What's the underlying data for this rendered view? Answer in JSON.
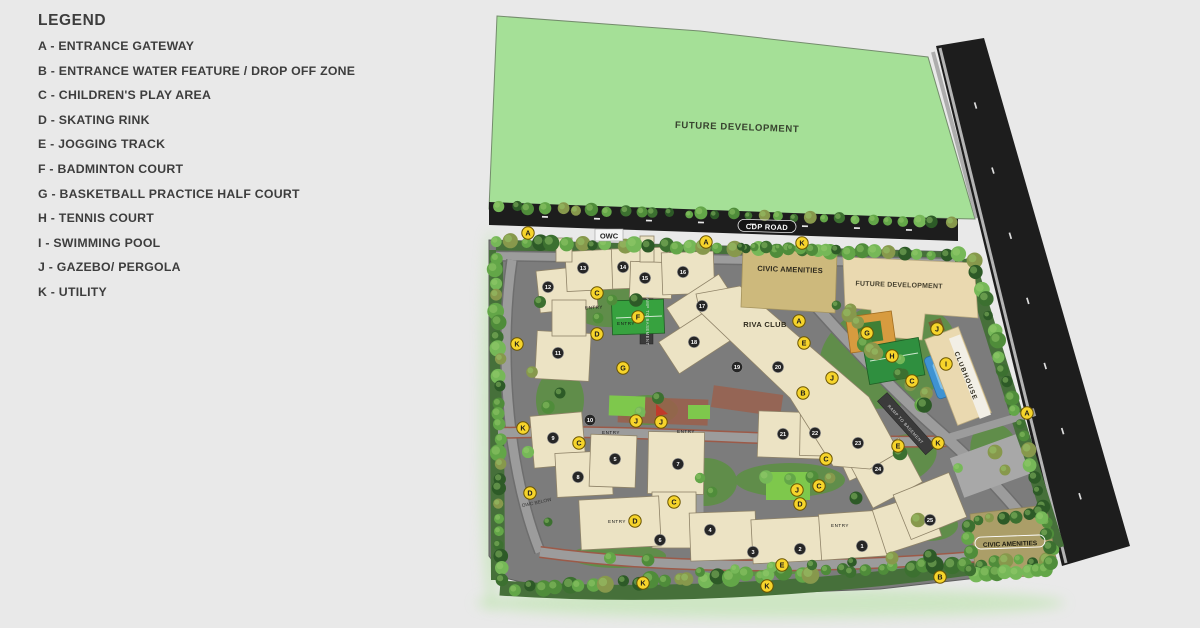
{
  "theme": {
    "page-bg": "#e9e9e9",
    "text-dark": "#3d3d3d",
    "green-area": "#a5e097",
    "road-black": "#1d1d1d",
    "site-gray": "#7c7c7c",
    "road-gray": "#9c9c9c",
    "building": "#ece3c4",
    "building-edge": "#8f8368",
    "civic-tan": "#cdb97c",
    "civic-olive": "#ab9e68",
    "beige": "#ead9b0",
    "court-orange": "#d79b3f",
    "court-green": "#2f8f3f",
    "pool-blue": "#3f93d2",
    "lawn": "#7ec84c",
    "plaza-rust": "#9b5f4b",
    "marker-yellow": "#f6d42b",
    "tower-dark": "#262626"
  },
  "legend": {
    "title": "LEGEND",
    "items": [
      {
        "key": "A",
        "text": "A - ENTRANCE GATEWAY"
      },
      {
        "key": "B",
        "text": "B - ENTRANCE WATER FEATURE / DROP OFF ZONE"
      },
      {
        "key": "C",
        "text": "C - CHILDREN'S PLAY AREA"
      },
      {
        "key": "D",
        "text": "D - SKATING RINK"
      },
      {
        "key": "E",
        "text": "E - JOGGING TRACK"
      },
      {
        "key": "F",
        "text": "F - BADMINTON COURT"
      },
      {
        "key": "G",
        "text": "G - BASKETBALL PRACTICE HALF COURT"
      },
      {
        "key": "H",
        "text": "H - TENNIS COURT"
      },
      {
        "key": "I",
        "text": "I - SWIMMING POOL"
      },
      {
        "key": "J",
        "text": "J - GAZEBO/ PERGOLA"
      },
      {
        "key": "K",
        "text": "K - UTILITY"
      }
    ]
  },
  "map": {
    "labels": {
      "future_development_top": "FUTURE DEVELOPMENT",
      "cdp_road": "CDP ROAD",
      "owc": "OWC",
      "civic_amenities_top": "CIVIC AMENITIES",
      "future_development_right": "FUTURE DEVELOPMENT",
      "riva_club": "RIVA CLUB",
      "clubhouse": "CLUBHOUSE",
      "civic_amenities_bottom": "CIVIC AMENITIES",
      "owc_below": "OWC BELOW",
      "ramp_to_basement": "RAMP TO BASEMENT",
      "entry": "ENTRY"
    },
    "markers": [
      {
        "letter": "A",
        "x": 528,
        "y": 233
      },
      {
        "letter": "A",
        "x": 706,
        "y": 242
      },
      {
        "letter": "A",
        "x": 799,
        "y": 321
      },
      {
        "letter": "A",
        "x": 1027,
        "y": 413
      },
      {
        "letter": "B",
        "x": 803,
        "y": 393
      },
      {
        "letter": "B",
        "x": 940,
        "y": 577
      },
      {
        "letter": "C",
        "x": 597,
        "y": 293
      },
      {
        "letter": "C",
        "x": 579,
        "y": 443
      },
      {
        "letter": "C",
        "x": 674,
        "y": 502
      },
      {
        "letter": "C",
        "x": 826,
        "y": 459
      },
      {
        "letter": "C",
        "x": 819,
        "y": 486
      },
      {
        "letter": "C",
        "x": 912,
        "y": 381
      },
      {
        "letter": "D",
        "x": 597,
        "y": 334
      },
      {
        "letter": "D",
        "x": 530,
        "y": 493
      },
      {
        "letter": "D",
        "x": 800,
        "y": 504
      },
      {
        "letter": "D",
        "x": 635,
        "y": 521
      },
      {
        "letter": "E",
        "x": 804,
        "y": 343
      },
      {
        "letter": "E",
        "x": 898,
        "y": 446
      },
      {
        "letter": "E",
        "x": 782,
        "y": 565
      },
      {
        "letter": "F",
        "x": 638,
        "y": 317
      },
      {
        "letter": "G",
        "x": 623,
        "y": 368
      },
      {
        "letter": "G",
        "x": 867,
        "y": 333
      },
      {
        "letter": "H",
        "x": 892,
        "y": 356
      },
      {
        "letter": "I",
        "x": 946,
        "y": 364
      },
      {
        "letter": "J",
        "x": 937,
        "y": 329
      },
      {
        "letter": "J",
        "x": 832,
        "y": 378
      },
      {
        "letter": "J",
        "x": 636,
        "y": 421
      },
      {
        "letter": "J",
        "x": 661,
        "y": 422
      },
      {
        "letter": "J",
        "x": 797,
        "y": 490
      },
      {
        "letter": "K",
        "x": 802,
        "y": 243
      },
      {
        "letter": "K",
        "x": 517,
        "y": 344
      },
      {
        "letter": "K",
        "x": 523,
        "y": 428
      },
      {
        "letter": "K",
        "x": 938,
        "y": 443
      },
      {
        "letter": "K",
        "x": 643,
        "y": 583
      },
      {
        "letter": "K",
        "x": 767,
        "y": 586
      }
    ],
    "towers": [
      {
        "n": "1",
        "x": 862,
        "y": 546
      },
      {
        "n": "2",
        "x": 800,
        "y": 549
      },
      {
        "n": "3",
        "x": 753,
        "y": 552
      },
      {
        "n": "4",
        "x": 710,
        "y": 530
      },
      {
        "n": "5",
        "x": 615,
        "y": 459
      },
      {
        "n": "6",
        "x": 660,
        "y": 540
      },
      {
        "n": "7",
        "x": 678,
        "y": 464
      },
      {
        "n": "8",
        "x": 578,
        "y": 477
      },
      {
        "n": "9",
        "x": 553,
        "y": 438
      },
      {
        "n": "10",
        "x": 590,
        "y": 420
      },
      {
        "n": "11",
        "x": 558,
        "y": 353
      },
      {
        "n": "12",
        "x": 548,
        "y": 287
      },
      {
        "n": "13",
        "x": 583,
        "y": 268
      },
      {
        "n": "14",
        "x": 623,
        "y": 267
      },
      {
        "n": "15",
        "x": 645,
        "y": 278
      },
      {
        "n": "16",
        "x": 683,
        "y": 272
      },
      {
        "n": "17",
        "x": 702,
        "y": 306
      },
      {
        "n": "18",
        "x": 694,
        "y": 342
      },
      {
        "n": "19",
        "x": 737,
        "y": 367
      },
      {
        "n": "20",
        "x": 778,
        "y": 367
      },
      {
        "n": "21",
        "x": 783,
        "y": 434
      },
      {
        "n": "22",
        "x": 815,
        "y": 433
      },
      {
        "n": "23",
        "x": 858,
        "y": 443
      },
      {
        "n": "24",
        "x": 878,
        "y": 469
      },
      {
        "n": "25",
        "x": 930,
        "y": 520
      }
    ],
    "entry_positions": [
      {
        "x": 594,
        "y": 309,
        "rot": -2
      },
      {
        "x": 626,
        "y": 325,
        "rot": 0
      },
      {
        "x": 611,
        "y": 434,
        "rot": 0
      },
      {
        "x": 686,
        "y": 433,
        "rot": 0
      },
      {
        "x": 617,
        "y": 523,
        "rot": 0
      },
      {
        "x": 840,
        "y": 527,
        "rot": 0
      }
    ]
  }
}
